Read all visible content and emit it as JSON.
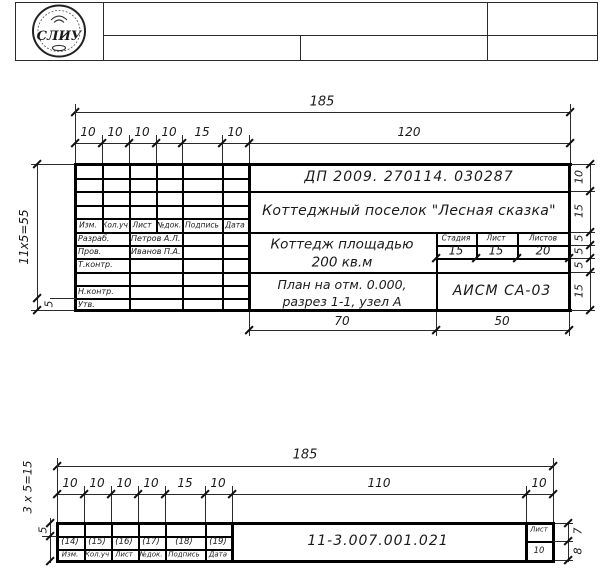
{
  "stamp": {
    "text": "СЛИУ"
  },
  "main_block": {
    "dims": {
      "total": "185",
      "segments": [
        "10",
        "10",
        "10",
        "10",
        "15",
        "10",
        "120"
      ],
      "height_total": "11x5=55",
      "height_row": "5",
      "right": [
        "10",
        "15",
        "5",
        "5",
        "5",
        "15"
      ],
      "bottom": [
        "70",
        "50"
      ],
      "stage_widths": [
        "15",
        "15",
        "20"
      ]
    },
    "doc_number": "ДП  2009.  270114.  030287",
    "project_name": "Коттеджный поселок  \"Лесная сказка\"",
    "object_line1": "Коттедж площадью",
    "object_line2": "200 кв.м",
    "sheet_title_line1": "План на отм.  0.000,",
    "sheet_title_line2": "разрез  1-1,  узел А",
    "org_code": "АИСМ  СА-03",
    "stage_headers": [
      "Стадия",
      "Лист",
      "Листов"
    ],
    "columns": [
      "Изм.",
      "Кол.уч",
      "Лист",
      "№док.",
      "Подпись",
      "Дата"
    ],
    "signature_rows": [
      {
        "role": "Разраб.",
        "name": "Петров А.Л."
      },
      {
        "role": "Пров.",
        "name": "Иванов П.А."
      },
      {
        "role": "Т.контр.",
        "name": ""
      },
      {
        "role": "",
        "name": ""
      },
      {
        "role": "Н.контр.",
        "name": ""
      },
      {
        "role": "Утв.",
        "name": ""
      }
    ]
  },
  "strip_block": {
    "dims": {
      "total": "185",
      "segments": [
        "10",
        "10",
        "10",
        "10",
        "15",
        "10",
        "110",
        "10"
      ],
      "height_total": "3 x 5=15",
      "height_row": "5",
      "right": [
        "7",
        "8"
      ]
    },
    "cell_numbers": [
      "(14)",
      "(15)",
      "(16)",
      "(17)",
      "(18)",
      "(19)"
    ],
    "columns": [
      "Изм.",
      "Кол.уч",
      "Лист",
      "№док.",
      "Подпись",
      "Дата"
    ],
    "doc_number": "11-3.007.001.021",
    "sheet_label": "Лист",
    "sheet_value": "10"
  }
}
